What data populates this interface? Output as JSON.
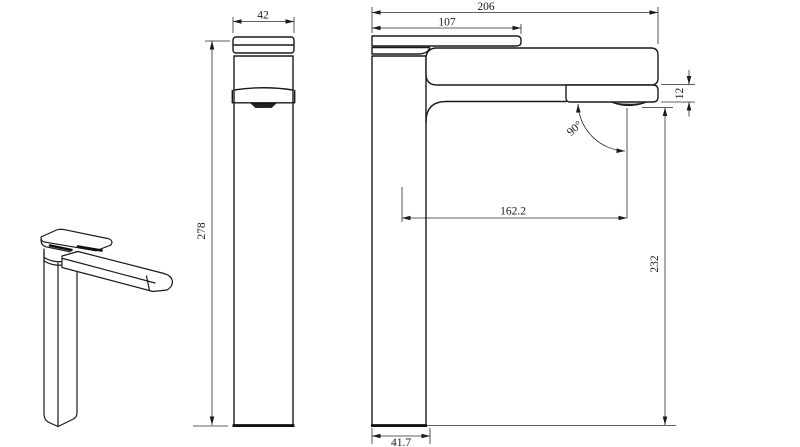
{
  "drawing": {
    "background_color": "#ffffff",
    "line_color": "#1a1a1a"
  },
  "views": {
    "front": {
      "dimensions": {
        "width": "42",
        "height": "278"
      }
    },
    "side": {
      "dimensions": {
        "overall_length": "206",
        "handle_length": "107",
        "spout_thickness": "12",
        "spout_angle": "90°",
        "spout_reach": "162.2",
        "outlet_height": "232",
        "base_depth": "41.7"
      }
    }
  }
}
